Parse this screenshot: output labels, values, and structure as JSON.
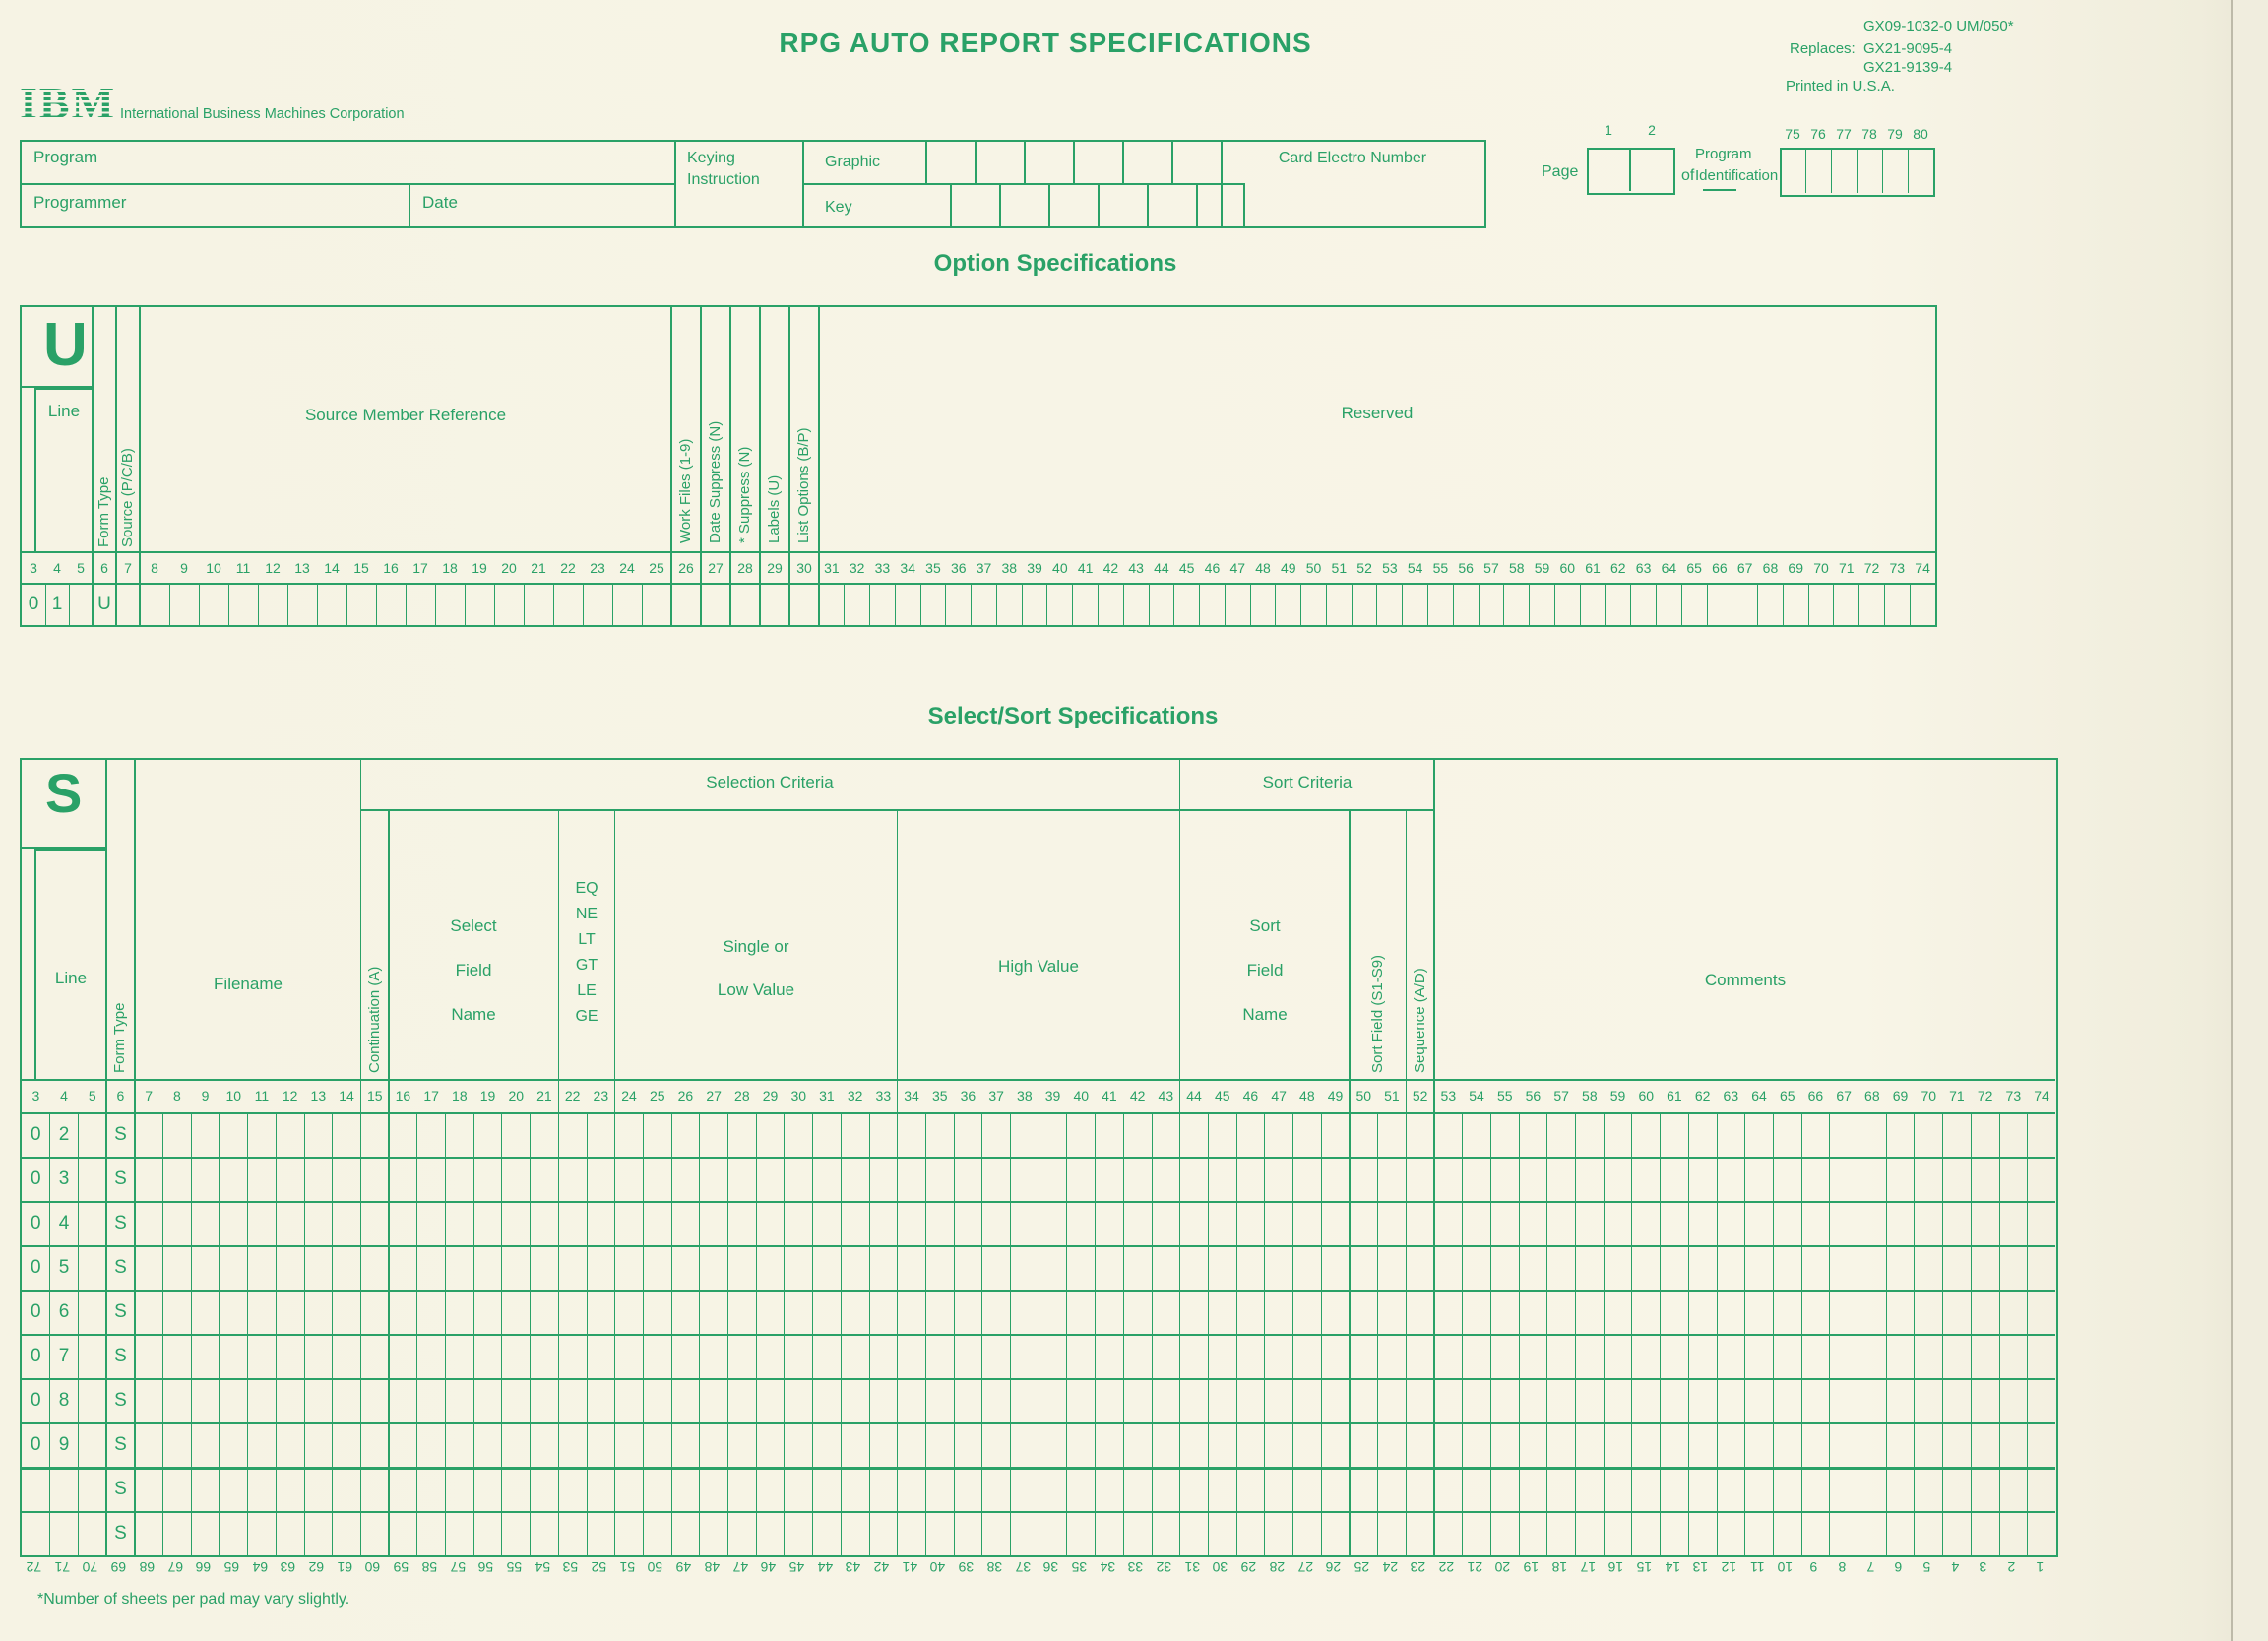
{
  "page": {
    "title": "RPG AUTO REPORT SPECIFICATIONS",
    "form_numbers": {
      "primary": "GX09-1032-0 UM/050*",
      "replaces_label": "Replaces:",
      "replaces": [
        "GX21-9095-4",
        "GX21-9139-4"
      ],
      "printed": "Printed in U.S.A."
    },
    "ibm": {
      "logo": "IBM",
      "company": "International Business Machines Corporation"
    },
    "colors": {
      "green": "#2aa167",
      "paper": "#f6f3e4"
    }
  },
  "header": {
    "program_label": "Program",
    "programmer_label": "Programmer",
    "date_label": "Date",
    "keying_lines": [
      "Keying",
      "Instruction"
    ],
    "graphic_label": "Graphic",
    "key_label": "Key",
    "card_electro_label": "Card Electro Number",
    "page_label": "Page",
    "page_column_numbers": [
      "1",
      "2"
    ],
    "of_label": "of",
    "program_id_lines": [
      "Program",
      "Identification"
    ],
    "id_column_numbers": [
      "75",
      "76",
      "77",
      "78",
      "79",
      "80"
    ]
  },
  "columns_3_to_74": [
    3,
    4,
    5,
    6,
    7,
    8,
    9,
    10,
    11,
    12,
    13,
    14,
    15,
    16,
    17,
    18,
    19,
    20,
    21,
    22,
    23,
    24,
    25,
    26,
    27,
    28,
    29,
    30,
    31,
    32,
    33,
    34,
    35,
    36,
    37,
    38,
    39,
    40,
    41,
    42,
    43,
    44,
    45,
    46,
    47,
    48,
    49,
    50,
    51,
    52,
    53,
    54,
    55,
    56,
    57,
    58,
    59,
    60,
    61,
    62,
    63,
    64,
    65,
    66,
    67,
    68,
    69,
    70,
    71,
    72,
    73,
    74
  ],
  "option": {
    "heading": "Option Specifications",
    "big_letter": "U",
    "line_label": "Line",
    "form_type_label": "Form Type",
    "source_label": "Source (P/C/B)",
    "member_label": "Source Member Reference",
    "narrow_labels": [
      "Work Files (1-9)",
      "Date Suppress (N)",
      "* Suppress (N)",
      "Labels (U)",
      "List Options (B/P)"
    ],
    "reserved_label": "Reserved",
    "entry": {
      "d1": "0",
      "d2": "1",
      "form_type": "U"
    }
  },
  "select": {
    "heading": "Select/Sort Specifications",
    "big_letter": "S",
    "selection_criteria_label": "Selection Criteria",
    "sort_criteria_label": "Sort Criteria",
    "line_label": "Line",
    "form_type_label": "Form Type",
    "filename_label": "Filename",
    "continuation_label": "Continuation (A)",
    "select_field_lines": [
      "Select",
      "Field",
      "Name"
    ],
    "relations": [
      "EQ",
      "NE",
      "LT",
      "GT",
      "LE",
      "GE"
    ],
    "single_low_lines": [
      "Single or",
      "Low Value"
    ],
    "high_value_label": "High Value",
    "sort_field_lines": [
      "Sort",
      "Field",
      "Name"
    ],
    "sort_field_s_label": "Sort Field (S1-S9)",
    "sequence_label": "Sequence (A/D)",
    "comments_label": "Comments",
    "rows": [
      {
        "d1": "0",
        "d2": "2",
        "form_type": "S"
      },
      {
        "d1": "0",
        "d2": "3",
        "form_type": "S"
      },
      {
        "d1": "0",
        "d2": "4",
        "form_type": "S"
      },
      {
        "d1": "0",
        "d2": "5",
        "form_type": "S"
      },
      {
        "d1": "0",
        "d2": "6",
        "form_type": "S"
      },
      {
        "d1": "0",
        "d2": "7",
        "form_type": "S"
      },
      {
        "d1": "0",
        "d2": "8",
        "form_type": "S"
      },
      {
        "d1": "0",
        "d2": "9",
        "form_type": "S"
      },
      {
        "d1": "",
        "d2": "",
        "form_type": "S"
      },
      {
        "d1": "",
        "d2": "",
        "form_type": "S"
      }
    ],
    "bottom_numbers": [
      72,
      71,
      70,
      69,
      68,
      67,
      66,
      65,
      64,
      63,
      62,
      61,
      60,
      59,
      58,
      57,
      56,
      55,
      54,
      53,
      52,
      51,
      50,
      49,
      48,
      47,
      46,
      45,
      44,
      43,
      42,
      41,
      40,
      39,
      38,
      37,
      36,
      35,
      34,
      33,
      32,
      31,
      30,
      29,
      28,
      27,
      26,
      25,
      24,
      23,
      22,
      21,
      20,
      19,
      18,
      17,
      16,
      15,
      14,
      13,
      12,
      11,
      10,
      9,
      8,
      7,
      6,
      5,
      4,
      3,
      2,
      1
    ],
    "footnote": "*Number of sheets per pad may vary slightly."
  }
}
